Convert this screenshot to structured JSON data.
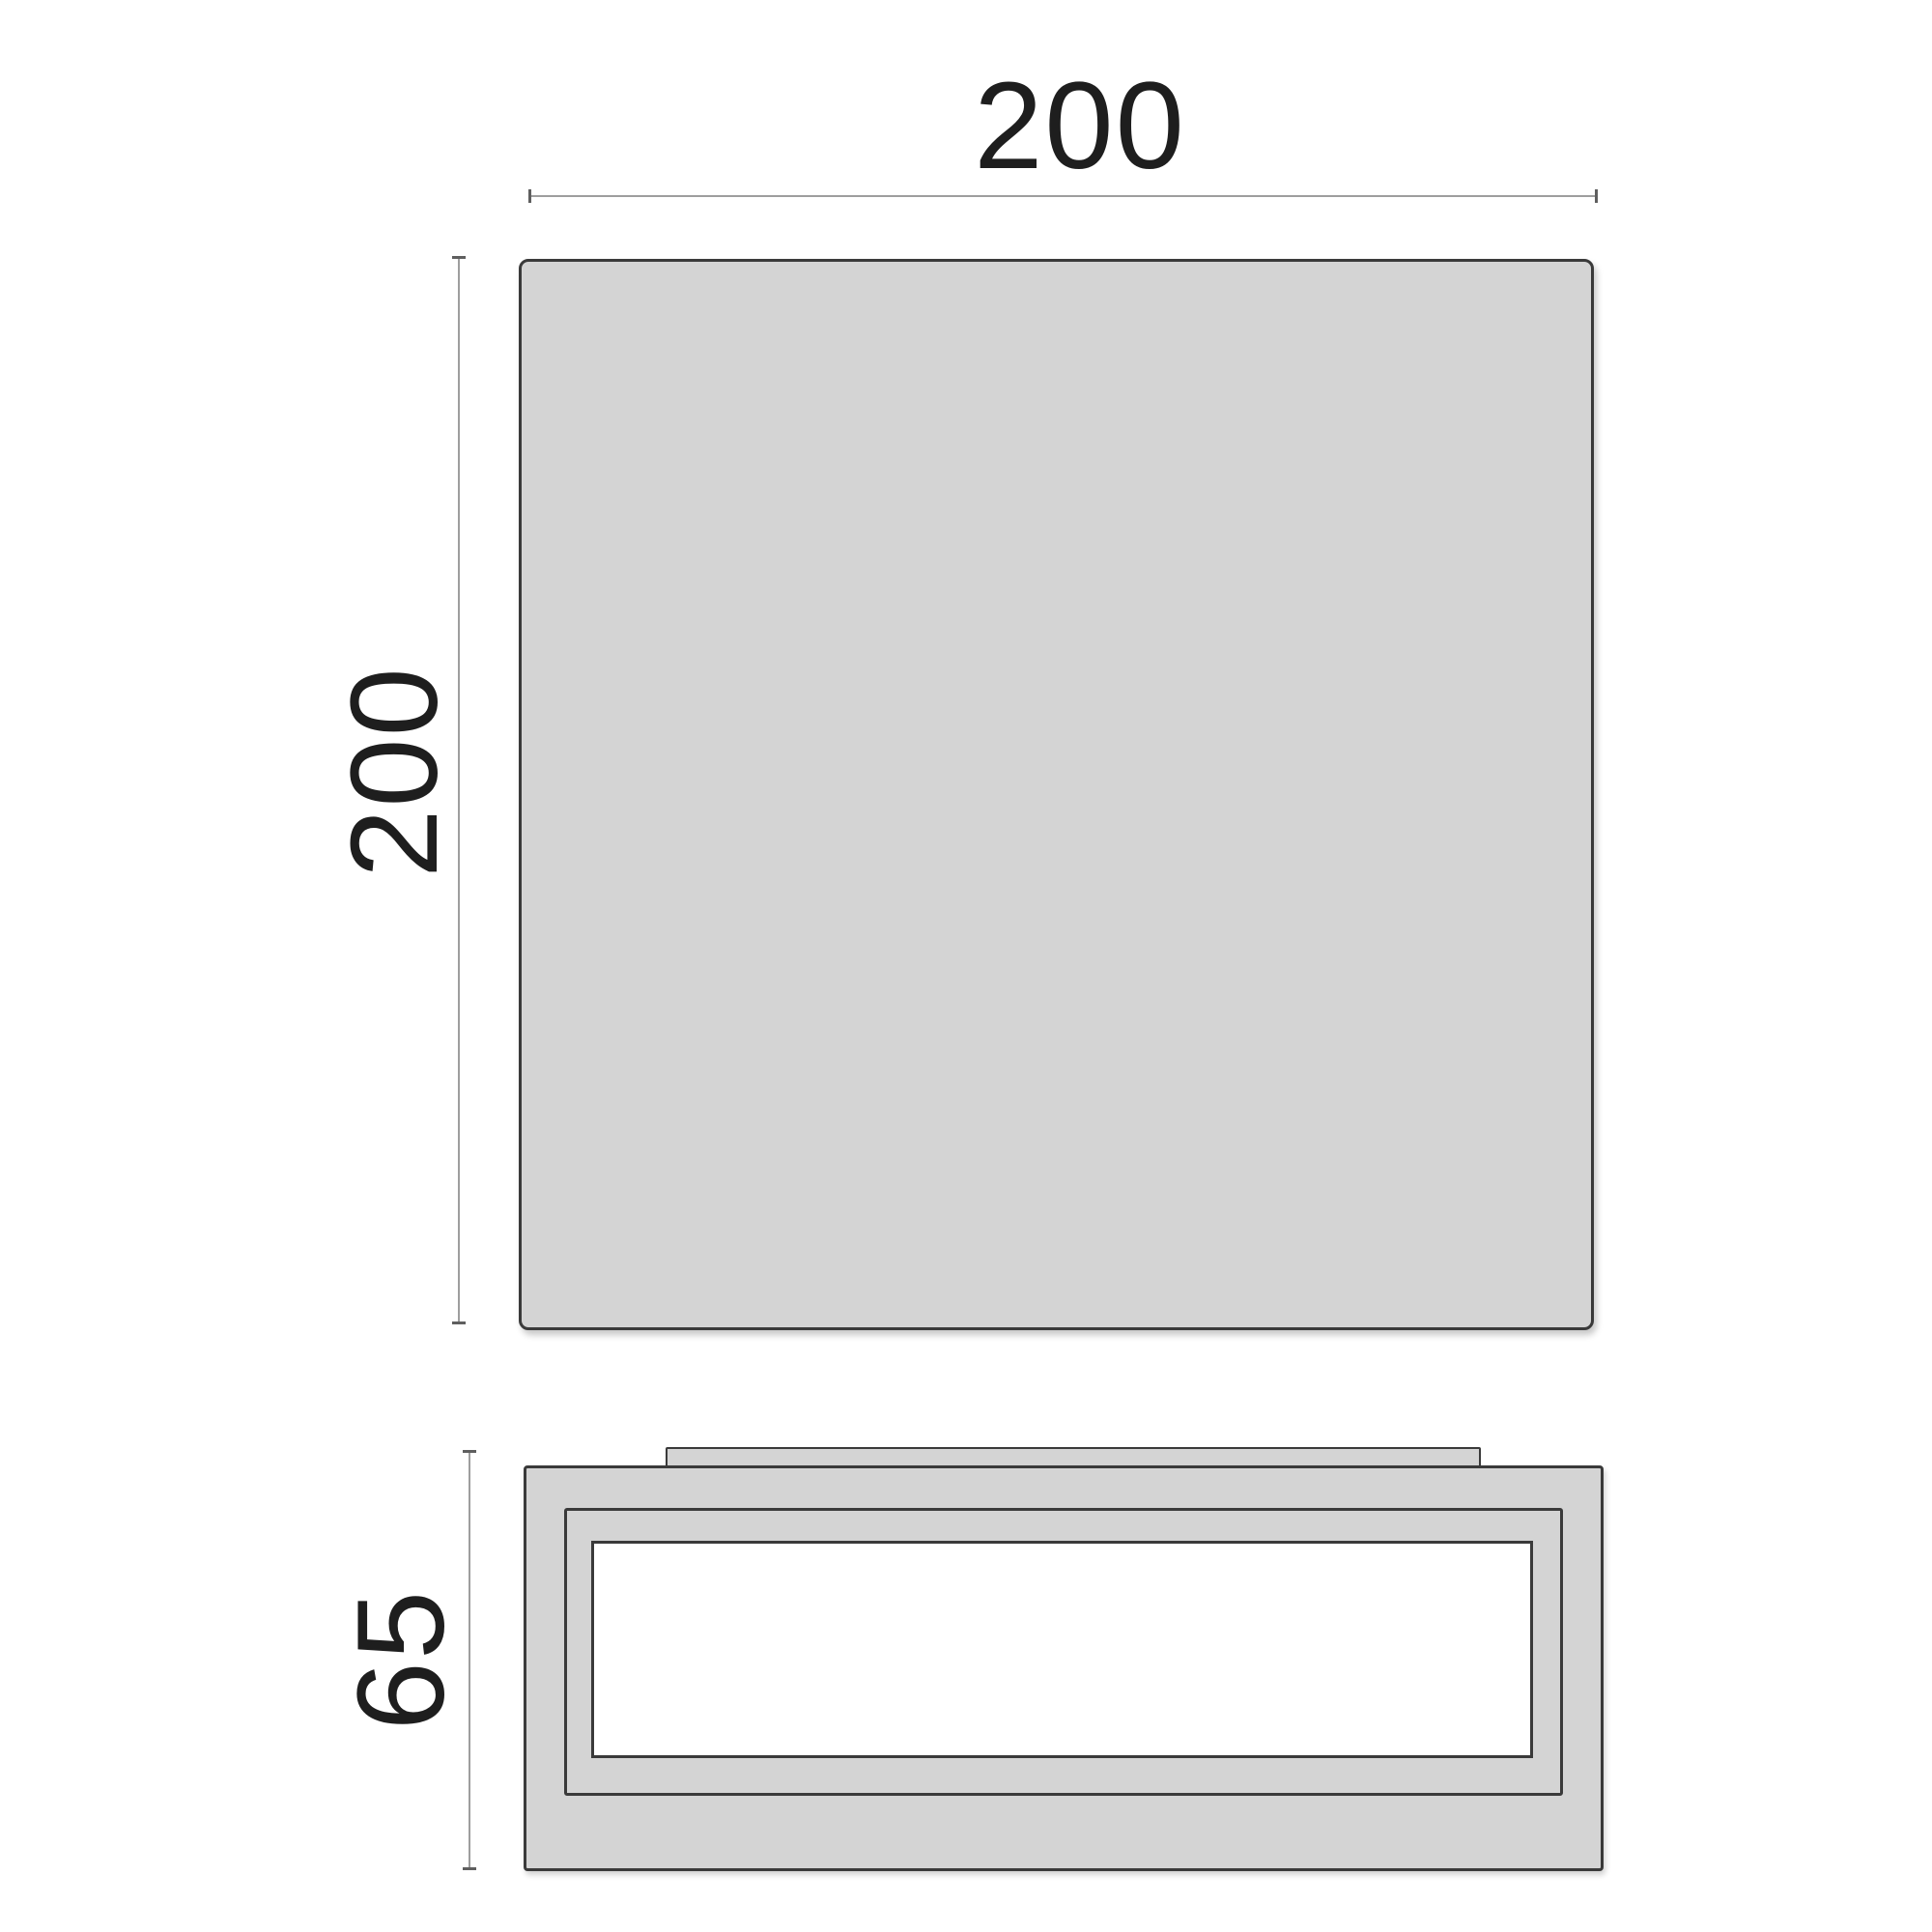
{
  "drawing": {
    "title": "luminaire-dimension-drawing",
    "top_view": {
      "width_label": "200",
      "height_label": "200"
    },
    "side_view": {
      "height_label": "65"
    },
    "colors": {
      "bg": "#ffffff",
      "fill": "#d4d4d4",
      "outline": "#3a3a3a",
      "dim_line": "#9e9e9e",
      "dim_tick": "#5f5f5f",
      "text": "#1e1e1e",
      "white": "#ffffff"
    }
  }
}
